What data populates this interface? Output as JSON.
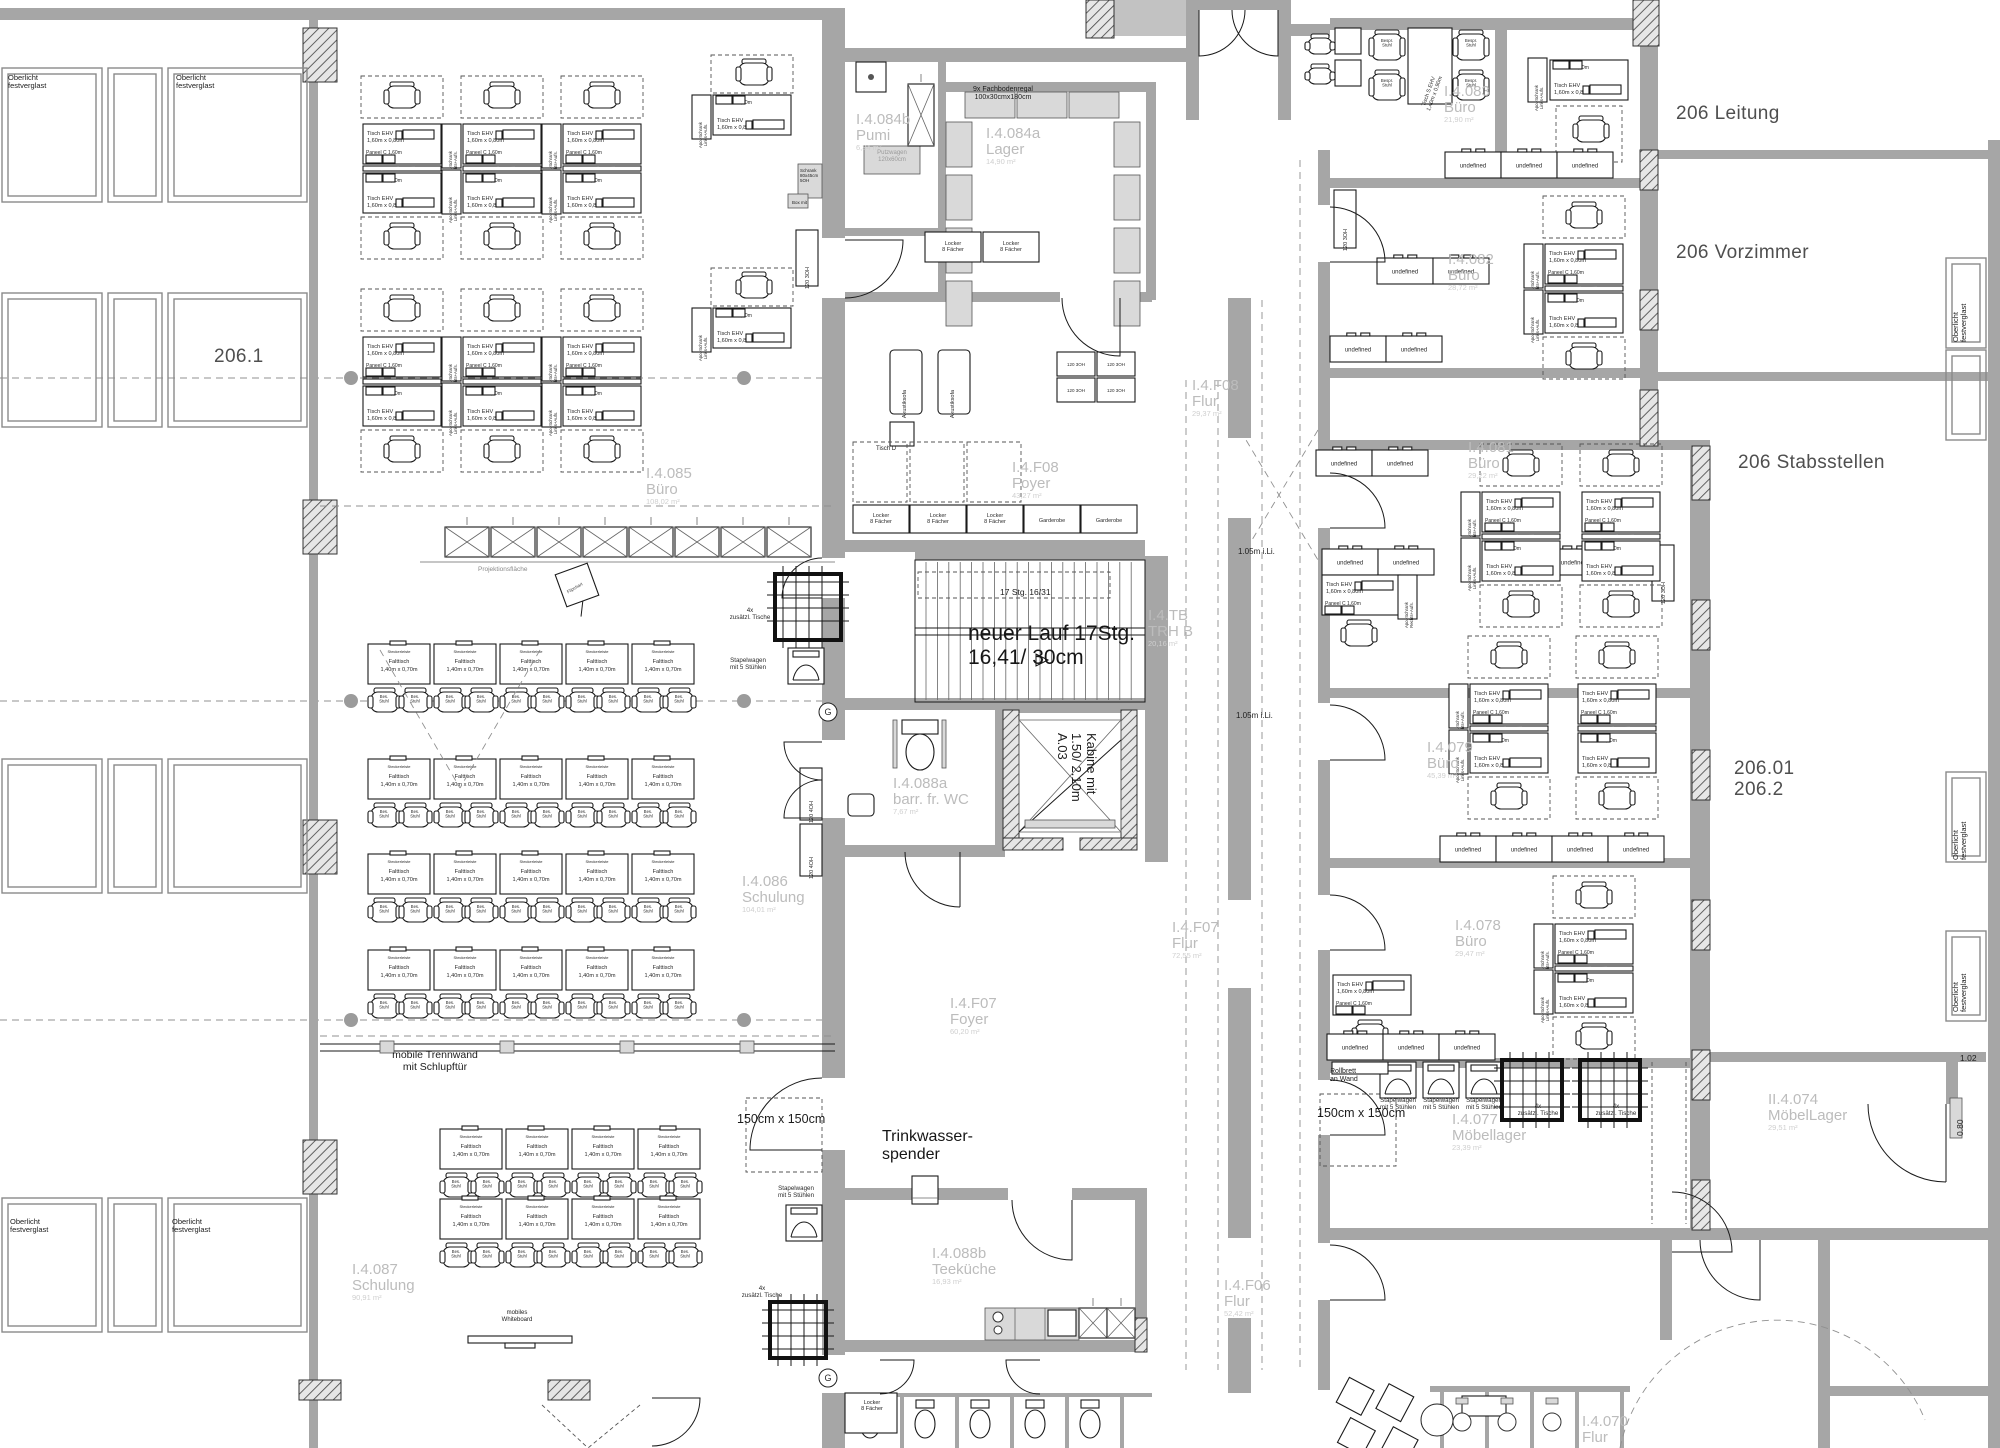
{
  "title": "Grundriss Ebene I.4 — Umbau 206",
  "strings": {
    "tisch_ehv_1": "Tisch EHV",
    "tisch_ehv_2": "1,60m x 0,80m",
    "paneel": "Paneel C 1,60m",
    "apo_links": "Apo.-Schrank Links+Aufs.",
    "apo_rechts": "Apo.-Schrank Rechts+Aufs.",
    "cab3": "120 3OH",
    "cab4": "120 4OH",
    "steckerleiste": "Steckerleiste",
    "falttisch": "Falttisch",
    "falttisch_dim": "1,40m x 0,70m",
    "bes_stuhl": "Bes. Stuhl",
    "bespr_stuhl": "Bespr. Stuhl",
    "tisch_s": "Tisch S EHV 1,40m x 0,90m",
    "locker": "Locker 8 Fächer",
    "garderobe": "Garderobe",
    "akustiksofa": "Akustiksofa",
    "tisch_d": "Tisch D",
    "stapelwagen": "Stapelwagen mit 5 Stühlen",
    "tische4": "4x zusätzl. Tische",
    "schrank5oh": "Schrank 80x45cm 5OH",
    "box_mit": "Box mit",
    "putzwagen": "Putzwagen 120x60cm",
    "g_mark": "G"
  },
  "labels": [
    {
      "name": "zone-206-1",
      "kind": "zone",
      "text": "206.1",
      "x": 214,
      "y": 346,
      "size": 19
    },
    {
      "name": "zone-206-leitung",
      "kind": "zone",
      "text": "206 Leitung",
      "x": 1676,
      "y": 103,
      "size": 19
    },
    {
      "name": "zone-206-vorzimmer",
      "kind": "zone",
      "text": "206 Vorzimmer",
      "x": 1676,
      "y": 242,
      "size": 19
    },
    {
      "name": "zone-206-stabsstellen",
      "kind": "zone",
      "text": "206 Stabsstellen",
      "x": 1738,
      "y": 452,
      "size": 19
    },
    {
      "name": "zone-206-01-206-2",
      "kind": "zone",
      "text": "206.01\n206.2",
      "x": 1734,
      "y": 758,
      "size": 19
    },
    {
      "name": "room-label-084b",
      "kind": "room",
      "main": "I.4.084b\nPumi",
      "area": "6,34 m²",
      "x": 856,
      "y": 112
    },
    {
      "name": "room-label-084a",
      "kind": "room",
      "main": "I.4.084a\nLager",
      "area": "14,90 m²",
      "x": 986,
      "y": 126
    },
    {
      "name": "room-label-085",
      "kind": "room",
      "main": "I.4.085\nBüro",
      "area": "108,02 m²",
      "x": 646,
      "y": 466
    },
    {
      "name": "room-label-086",
      "kind": "room",
      "main": "I.4.086\nSchulung",
      "area": "104,01 m²",
      "x": 742,
      "y": 874
    },
    {
      "name": "room-label-087",
      "kind": "room",
      "main": "I.4.087\nSchulung",
      "area": "90,91 m²",
      "x": 352,
      "y": 1262
    },
    {
      "name": "room-label-088a",
      "kind": "room",
      "main": "I.4.088a\nbarr. fr. WC",
      "area": "7,67 m²",
      "x": 893,
      "y": 776
    },
    {
      "name": "room-label-088b",
      "kind": "room",
      "main": "I.4.088b\nTeeküche",
      "area": "16,93 m²",
      "x": 932,
      "y": 1246
    },
    {
      "name": "room-label-f08-flur",
      "kind": "room",
      "main": "I.4.F08\nFlur",
      "area": "29,37 m²",
      "x": 1192,
      "y": 378
    },
    {
      "name": "room-label-f08-foyer",
      "kind": "room",
      "main": "I.4.F08\nFoyer",
      "area": "43,27 m²",
      "x": 1012,
      "y": 460
    },
    {
      "name": "room-label-trhb",
      "kind": "room",
      "main": "I.4.TB\nTRH B",
      "area": "20,16 m²",
      "x": 1148,
      "y": 608
    },
    {
      "name": "room-label-f07-flur",
      "kind": "room",
      "main": "I.4.F07\nFlur",
      "area": "72,55 m²",
      "x": 1172,
      "y": 920
    },
    {
      "name": "room-label-f07-foyer",
      "kind": "room",
      "main": "I.4.F07\nFoyer",
      "area": "60,20 m²",
      "x": 950,
      "y": 996
    },
    {
      "name": "room-label-f06",
      "kind": "room",
      "main": "I.4.F06\nFlur",
      "area": "52,42 m²",
      "x": 1224,
      "y": 1278
    },
    {
      "name": "room-label-083",
      "kind": "room",
      "main": "I.4.083\nBüro",
      "area": "21,90 m²",
      "x": 1444,
      "y": 84
    },
    {
      "name": "room-label-082",
      "kind": "room",
      "main": "I.4.082\nBüro",
      "area": "28,72 m²",
      "x": 1448,
      "y": 252
    },
    {
      "name": "room-label-081",
      "kind": "room",
      "main": "I.4.081\nBüro",
      "area": "29,22 m²",
      "x": 1468,
      "y": 440
    },
    {
      "name": "room-label-079",
      "kind": "room",
      "main": "I.4.079\nBüro",
      "area": "45,39 m²",
      "x": 1427,
      "y": 740
    },
    {
      "name": "room-label-078",
      "kind": "room",
      "main": "I.4.078\nBüro",
      "area": "29,47 m²",
      "x": 1455,
      "y": 918
    },
    {
      "name": "room-label-077",
      "kind": "room",
      "main": "I.4.077\nMöbellager",
      "area": "23,39 m²",
      "x": 1452,
      "y": 1112
    },
    {
      "name": "room-label-074",
      "kind": "room",
      "main": "II.4.074\nMöbelLager",
      "area": "29,51 m²",
      "x": 1768,
      "y": 1092
    },
    {
      "name": "room-label-070",
      "kind": "room",
      "main": "I.4.070\nFlur",
      "area": "",
      "x": 1582,
      "y": 1414
    },
    {
      "name": "note-fachbodenregal",
      "kind": "note",
      "text": "9x Fachbodenregal\n100x30cmx180cm",
      "x": 938,
      "y": 86,
      "size": 7,
      "align": "center",
      "w": 130
    },
    {
      "name": "note-putzwagen",
      "kind": "note",
      "text": "Putzwagen\n120x60cm",
      "x": 862,
      "y": 150,
      "size": 6,
      "color": "#9a9a9a",
      "align": "center",
      "w": 60
    },
    {
      "name": "note-17stg",
      "kind": "note",
      "text": "17 Stg.  16/31",
      "x": 1000,
      "y": 588,
      "size": 8.5
    },
    {
      "name": "note-neuer-lauf",
      "kind": "note",
      "text": "neuer Lauf 17Stg.\n16,41/ 30cm",
      "x": 968,
      "y": 622,
      "size": 21,
      "color": "#161616"
    },
    {
      "name": "note-kabine",
      "kind": "note",
      "text": "Kabine mit\n1.50/ 2.10m\nA.03",
      "x": 1098,
      "y": 733,
      "size": 13,
      "rot": 90
    },
    {
      "name": "note-trennwand",
      "kind": "note",
      "text": "mobile Trennwand\nmit Schlupftür",
      "x": 360,
      "y": 1050,
      "size": 10.5,
      "align": "center",
      "w": 150
    },
    {
      "name": "note-trinkwasser",
      "kind": "note",
      "text": "Trinkwasser-\nspender",
      "x": 882,
      "y": 1128,
      "size": 16,
      "color": "#161616"
    },
    {
      "name": "note-150cm-a",
      "kind": "note",
      "text": "150cm x 150cm",
      "x": 737,
      "y": 1112,
      "size": 12.5
    },
    {
      "name": "note-150cm-b",
      "kind": "note",
      "text": "150cm x 150cm",
      "x": 1317,
      "y": 1106,
      "size": 12.5
    },
    {
      "name": "note-rollbrett",
      "kind": "note",
      "text": "Rollbrett\nan Wand",
      "x": 1330,
      "y": 1068,
      "size": 7
    },
    {
      "name": "note-105-a",
      "kind": "note",
      "text": "1.05m i.Li.",
      "x": 1238,
      "y": 548,
      "size": 8
    },
    {
      "name": "note-105-b",
      "kind": "note",
      "text": "1.05m i.Li.",
      "x": 1236,
      "y": 712,
      "size": 8
    },
    {
      "name": "note-dim-102",
      "kind": "note",
      "text": "1.02",
      "x": 1960,
      "y": 1054,
      "size": 8.5
    },
    {
      "name": "note-dim-080",
      "kind": "note",
      "text": "0.80",
      "x": 1956,
      "y": 1136,
      "size": 8.5,
      "rot": -90
    },
    {
      "name": "note-projektionsflaeche",
      "kind": "note",
      "text": "Projektionsfläche",
      "x": 478,
      "y": 566,
      "size": 6.5,
      "color": "#8a8a8a"
    },
    {
      "name": "note-flipchart",
      "kind": "note",
      "text": "Flipchart",
      "x": 566,
      "y": 590,
      "size": 4.5,
      "rot": -30,
      "color": "#444"
    },
    {
      "name": "note-whiteboard",
      "kind": "note",
      "text": "mobiles\nWhiteboard",
      "x": 472,
      "y": 1310,
      "size": 6,
      "align": "center",
      "w": 90
    },
    {
      "name": "note-oberlicht-1",
      "kind": "note",
      "text": "Oberlicht\nfestverglast",
      "x": 8,
      "y": 74,
      "size": 7.5
    },
    {
      "name": "note-oberlicht-2",
      "kind": "note",
      "text": "Oberlicht\nfestverglast",
      "x": 176,
      "y": 74,
      "size": 7.5
    },
    {
      "name": "note-oberlicht-3",
      "kind": "note",
      "text": "Oberlicht\nfestverglast",
      "x": 10,
      "y": 1218,
      "size": 7.5
    },
    {
      "name": "note-oberlicht-4",
      "kind": "note",
      "text": "Oberlicht\nfestverglast",
      "x": 172,
      "y": 1218,
      "size": 7.5
    },
    {
      "name": "note-oberlicht-5",
      "kind": "note",
      "text": "Oberlicht\nfestverglast",
      "x": 1952,
      "y": 342,
      "size": 7.5,
      "rot": -90
    },
    {
      "name": "note-oberlicht-6",
      "kind": "note",
      "text": "Oberlicht\nfestverglast",
      "x": 1952,
      "y": 860,
      "size": 7.5,
      "rot": -90
    },
    {
      "name": "note-oberlicht-7",
      "kind": "note",
      "text": "Oberlicht\nfestverglast",
      "x": 1952,
      "y": 1012,
      "size": 7.5,
      "rot": -90
    },
    {
      "name": "note-schrank-5oh",
      "kind": "note",
      "text": "Schrank\n80x45cm\n5OH",
      "x": 800,
      "y": 168,
      "size": 4.5
    },
    {
      "name": "note-box-mit",
      "kind": "note",
      "text": "Box mit",
      "x": 792,
      "y": 200,
      "size": 4.5
    },
    {
      "name": "note-tisch-d",
      "kind": "note",
      "text": "Tisch D",
      "x": 876,
      "y": 446,
      "size": 6
    },
    {
      "name": "note-locker-bl",
      "kind": "note",
      "text": "Locker\n8 Fächer",
      "x": 849,
      "y": 1400,
      "size": 5.5,
      "align": "center",
      "w": 46
    }
  ]
}
